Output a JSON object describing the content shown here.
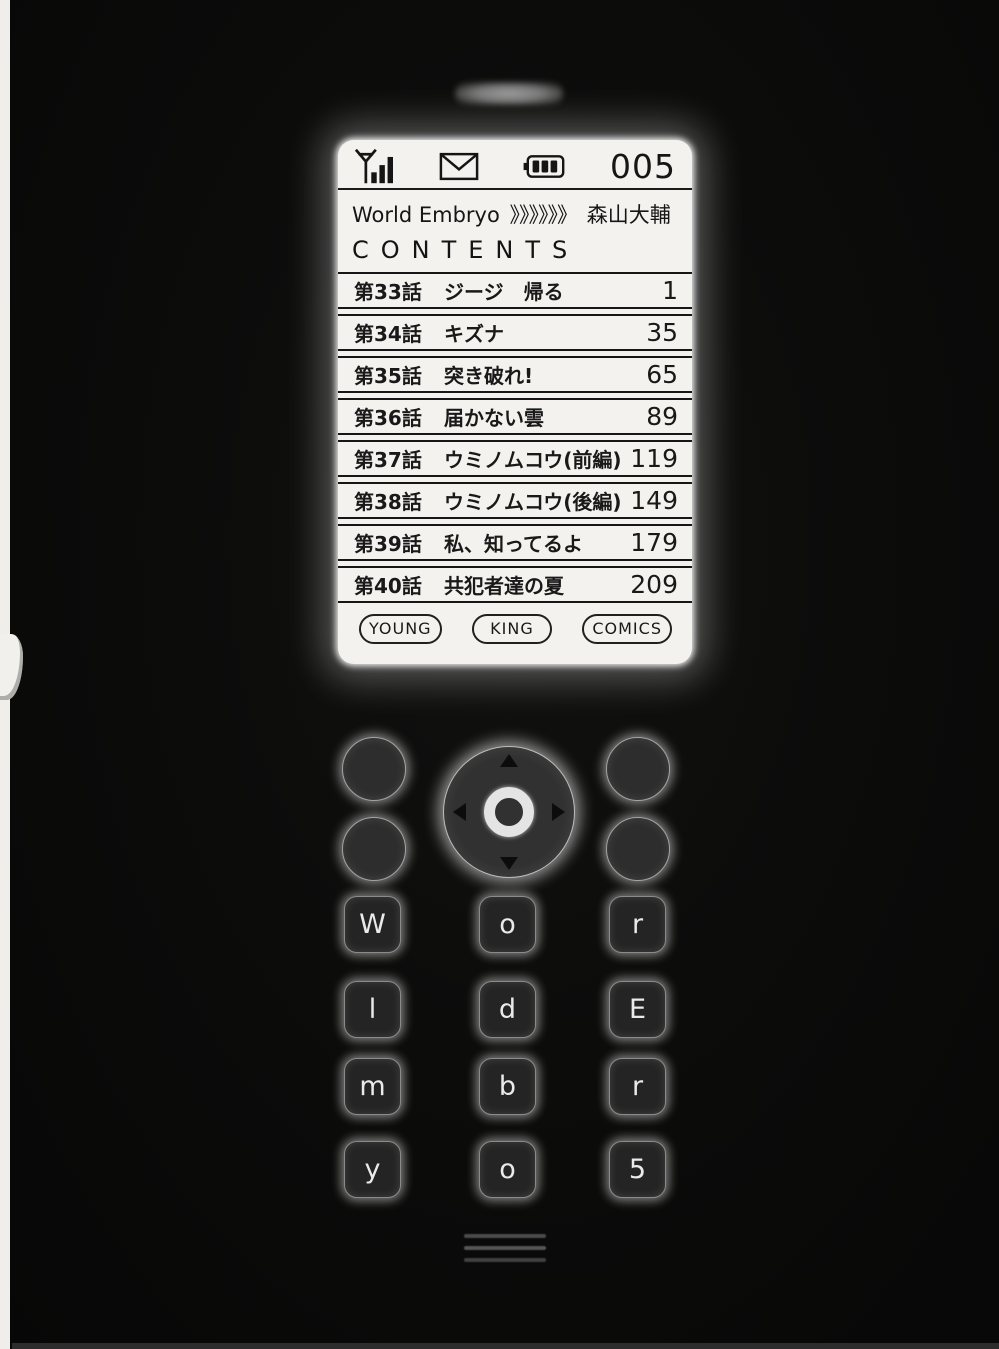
{
  "status_bar": {
    "signal_icon": "signal-antenna-icon",
    "mail_icon": "envelope-icon",
    "battery_icon": "battery-icon",
    "counter": "005"
  },
  "header": {
    "series_title": "World Embryo",
    "separator_marks": "》》》》》》",
    "author": "森山大輔",
    "contents_label": "CONTENTS"
  },
  "toc_rows": [
    {
      "chapter": "第33話",
      "title": "ジージ　帰る",
      "page": "1"
    },
    {
      "chapter": "第34話",
      "title": "キズナ",
      "page": "35"
    },
    {
      "chapter": "第35話",
      "title": "突き破れ!",
      "page": "65"
    },
    {
      "chapter": "第36話",
      "title": "届かない雲",
      "page": "89"
    },
    {
      "chapter": "第37話",
      "title": "ウミノムコウ(前編)",
      "page": "119"
    },
    {
      "chapter": "第38話",
      "title": "ウミノムコウ(後編)",
      "page": "149"
    },
    {
      "chapter": "第39話",
      "title": "私、知ってるよ",
      "page": "179"
    },
    {
      "chapter": "第40話",
      "title": "共犯者達の夏",
      "page": "209"
    }
  ],
  "badges": [
    "YOUNG",
    "KING",
    "COMICS"
  ],
  "keypad": {
    "keys": [
      "W",
      "o",
      "r",
      "l",
      "d",
      "E",
      "m",
      "b",
      "r",
      "y",
      "o",
      "5"
    ]
  },
  "colors": {
    "background": "#0b0b0a",
    "screen": "#f3f2ee",
    "ink": "#191919",
    "key_face": "#242424",
    "glow": "#ffffff"
  }
}
